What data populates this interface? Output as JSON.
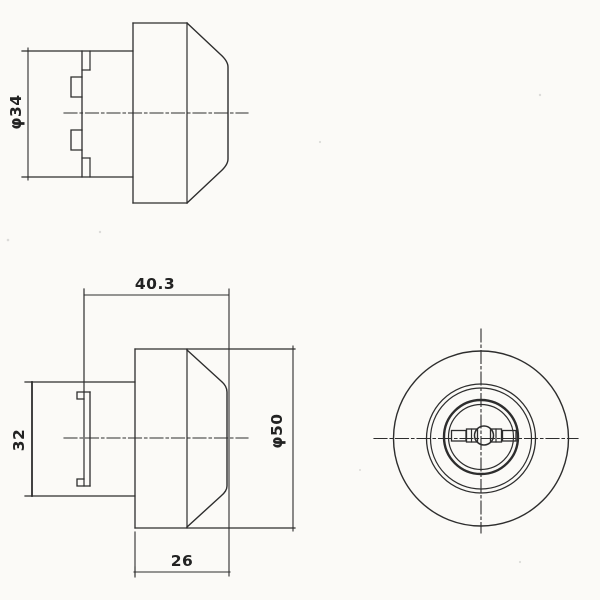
{
  "drawing": {
    "paper_color": "#fbfaf7",
    "ink_color": "#2d2d2d",
    "views": {
      "top_side_view": {
        "dimensions": {
          "barrel_diameter": "φ34"
        }
      },
      "front_side_view": {
        "dimensions": {
          "overall_length": "40.3",
          "barrel_diameter": "32",
          "head_diameter": "φ50",
          "head_length": "26"
        }
      },
      "face_view": {
        "features": {
          "keyhole": "double-sided key slot",
          "concentric_rings": 5
        }
      }
    }
  }
}
